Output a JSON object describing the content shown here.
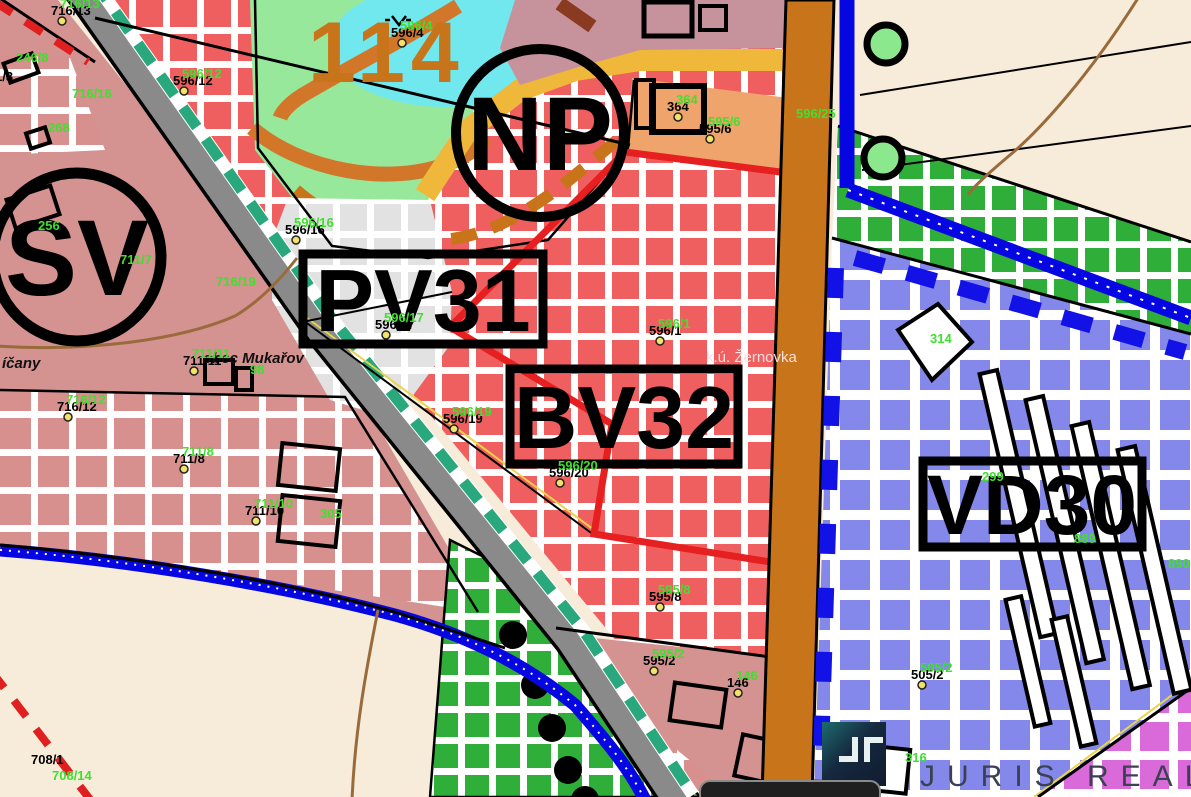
{
  "map": {
    "zones": {
      "np": "NP",
      "sv": "SV",
      "pv": "PV31",
      "bv": "BV32",
      "vd": "VD30"
    },
    "area_number": "114",
    "places": {
      "municipality": "obec Mukařov",
      "cadastre": "k.ú. Žernovka",
      "neighbor": "íčany"
    },
    "watermark": {
      "text": "JURIS REAL"
    },
    "footer_bar": {
      "label": ""
    },
    "colors": {
      "cream": "#f7ecd9",
      "red_zone": "#f05f5f",
      "rose_zone": "#d49290",
      "rose_check": "#d8908e",
      "gray_check": "#e2e2e2",
      "blue_zone": "#8488ea",
      "green_zone": "#2fae3a",
      "magenta_zone": "#da6ada",
      "np_green": "#98e89c",
      "pond_cyan": "#70e8ee",
      "orange_zone": "#efa46c",
      "mauve_zone": "#c6929b",
      "yellow_road": "#f0b83a",
      "orange_path": "#d2772a",
      "brown_road": "#c8741a",
      "gray_road": "#8a8a8a",
      "teal_dash": "#28a87c",
      "stream_blue": "#0506e2",
      "boundary_red": "#e62020",
      "deep_blue": "#1212e6",
      "contour_brown": "#9a6b3a",
      "label_green": "#3fe02e",
      "watermark_gray": "#3a4150"
    },
    "parcel_labels": [
      {
        "t": "716/13",
        "x": 60,
        "y": 8
      },
      {
        "t": "246/8",
        "x": 16,
        "y": 62,
        "m": "green"
      },
      {
        "t": "1/3",
        "x": 4,
        "y": 74,
        "m": "black"
      },
      {
        "t": "596/12",
        "x": 182,
        "y": 78
      },
      {
        "t": "716/16",
        "x": 72,
        "y": 98,
        "m": "green"
      },
      {
        "t": "268",
        "x": 48,
        "y": 132,
        "m": "green"
      },
      {
        "t": "256",
        "x": 38,
        "y": 230,
        "m": "green"
      },
      {
        "t": "596/4",
        "x": 400,
        "y": 30
      },
      {
        "t": "596/16",
        "x": 294,
        "y": 227
      },
      {
        "t": "711/7",
        "x": 120,
        "y": 264,
        "m": "green"
      },
      {
        "t": "716/19",
        "x": 216,
        "y": 286,
        "m": "green"
      },
      {
        "t": "596/17",
        "x": 384,
        "y": 322
      },
      {
        "t": "596/1",
        "x": 658,
        "y": 328
      },
      {
        "t": "711/11",
        "x": 192,
        "y": 358
      },
      {
        "t": "98",
        "x": 250,
        "y": 374,
        "m": "green"
      },
      {
        "t": "716/12",
        "x": 66,
        "y": 404
      },
      {
        "t": "596/19",
        "x": 452,
        "y": 416
      },
      {
        "t": "596/20",
        "x": 558,
        "y": 470
      },
      {
        "t": "711/8",
        "x": 182,
        "y": 456
      },
      {
        "t": "711/10",
        "x": 254,
        "y": 508
      },
      {
        "t": "305",
        "x": 320,
        "y": 518,
        "m": "green"
      },
      {
        "t": "595/8",
        "x": 658,
        "y": 594
      },
      {
        "t": "595/2",
        "x": 652,
        "y": 658
      },
      {
        "t": "146",
        "x": 736,
        "y": 680
      },
      {
        "t": "364",
        "x": 676,
        "y": 104
      },
      {
        "t": "595/6",
        "x": 708,
        "y": 126
      },
      {
        "t": "596/25",
        "x": 796,
        "y": 118,
        "m": "green"
      },
      {
        "t": "314",
        "x": 930,
        "y": 343,
        "m": "green"
      },
      {
        "t": "299",
        "x": 982,
        "y": 481,
        "m": "green"
      },
      {
        "t": "889",
        "x": 1074,
        "y": 543,
        "m": "green"
      },
      {
        "t": "890",
        "x": 1168,
        "y": 568,
        "m": "green"
      },
      {
        "t": "505/2",
        "x": 920,
        "y": 672
      },
      {
        "t": "316",
        "x": 905,
        "y": 762,
        "m": "green"
      },
      {
        "t": "708/1",
        "x": 40,
        "y": 757,
        "m": "black"
      },
      {
        "t": "708/14",
        "x": 52,
        "y": 780,
        "m": "green"
      }
    ]
  }
}
